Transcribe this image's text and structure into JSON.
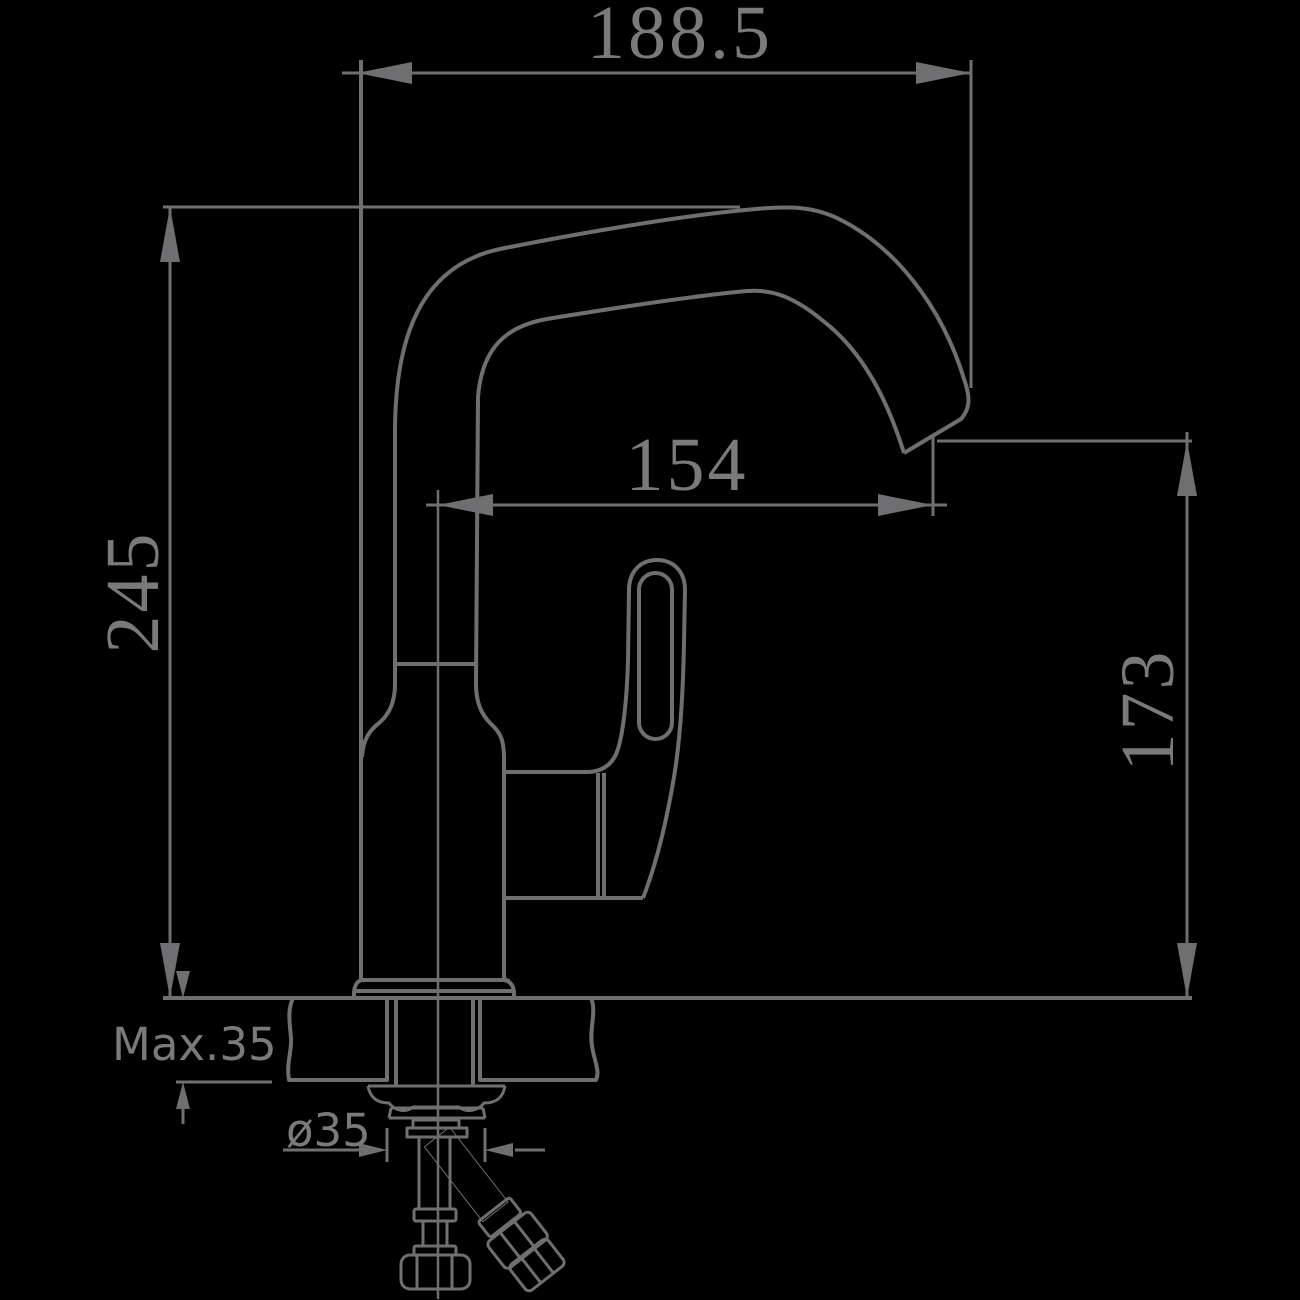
{
  "diagram": {
    "type": "technical-drawing",
    "subject": "single-handle-faucet-side-elevation-with-installation-dimensions",
    "dimensions": [
      {
        "id": "overall-width",
        "label": "188.5",
        "orientation": "horizontal"
      },
      {
        "id": "overall-height",
        "label": "245",
        "orientation": "vertical"
      },
      {
        "id": "spout-reach",
        "label": "154",
        "orientation": "horizontal"
      },
      {
        "id": "spout-outlet-height",
        "label": "173",
        "orientation": "vertical"
      },
      {
        "id": "max-mounting-thickness",
        "label": "Max.35",
        "orientation": "vertical"
      },
      {
        "id": "mounting-hole-diameter",
        "label": "ø35",
        "orientation": "horizontal"
      }
    ]
  },
  "colors": {
    "background": "#000000",
    "line": "#6f6f72",
    "text": "#7a7a7d"
  }
}
